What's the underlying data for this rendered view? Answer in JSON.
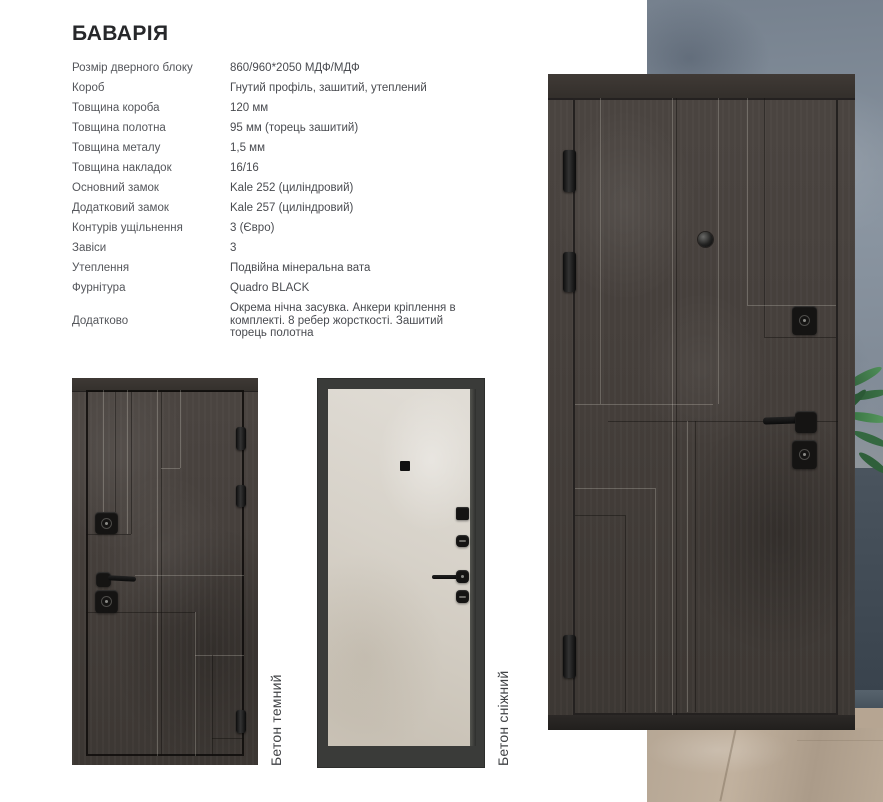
{
  "product": {
    "title": "БАВАРІЯ"
  },
  "specs": [
    {
      "label": "Розмір дверного блоку",
      "value": "860/960*2050 МДФ/МДФ"
    },
    {
      "label": "Короб",
      "value": "Гнутий профіль, зашитий, утеплений"
    },
    {
      "label": "Товщина короба",
      "value": "120 мм"
    },
    {
      "label": "Товщина полотна",
      "value": "95 мм (торець зашитий)"
    },
    {
      "label": "Товщина металу",
      "value": "1,5 мм"
    },
    {
      "label": "Товщина накладок",
      "value": "16/16"
    },
    {
      "label": "Основний замок",
      "value": "Kale 252 (циліндровий)"
    },
    {
      "label": "Додатковий замок",
      "value": "Kale 257 (циліндровий)"
    },
    {
      "label": "Контурів ущільнення",
      "value": "3 (Євро)"
    },
    {
      "label": "Завіси",
      "value": "3"
    },
    {
      "label": "Утеплення",
      "value": "Подвійна мінеральна вата"
    },
    {
      "label": "Фурнітура",
      "value": "Quadro BLACK"
    },
    {
      "label": "Додатково",
      "value": "Окрема нічна засувка. Анкери кріплення в комплекті. 8 ребер жорсткості. Зашитий торець полотна"
    }
  ],
  "variants": [
    {
      "name": "Бетон темний"
    },
    {
      "name": "Бетон сніжний"
    }
  ],
  "colors": {
    "door_dark": "#453f3b",
    "door_light": "#d8d3ca",
    "frame_dark": "#3a3b39",
    "wall_gray": "#828c98",
    "floor_beige": "#b3a392",
    "hardware_black": "#151413",
    "text_gray": "#54565b",
    "title_dark": "#26272a"
  }
}
